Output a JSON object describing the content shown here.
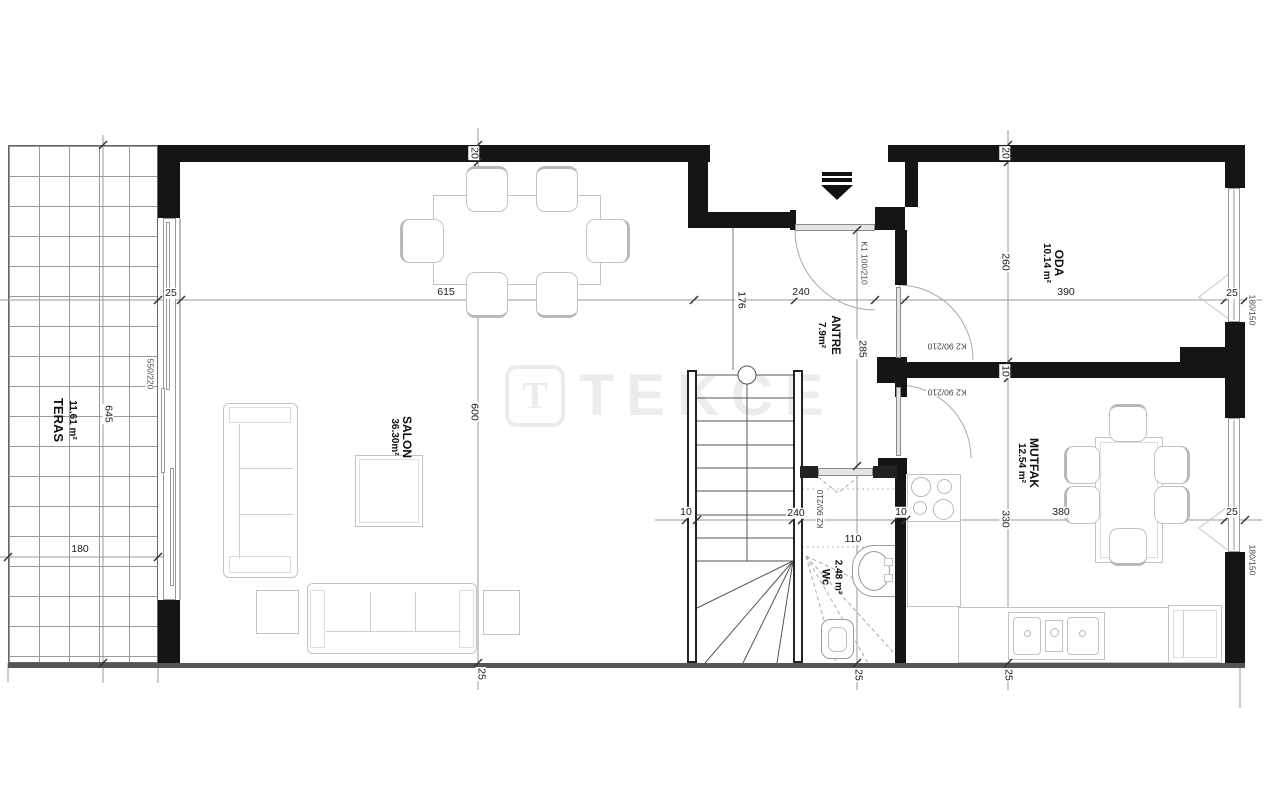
{
  "watermark": {
    "logo_letter": "T",
    "brand": "TEKCE"
  },
  "rooms": {
    "teras": {
      "line1": "11.61 m²",
      "line2": "TERAS"
    },
    "salon": {
      "line1": "SALON",
      "line2": "36.30m²"
    },
    "antre": {
      "line1": "ANTRE",
      "line2": "7.9m²"
    },
    "oda": {
      "line1": "ODA",
      "line2": "10.14 m²"
    },
    "mutfak": {
      "line1": "MUTFAK",
      "line2": "12.54 m²"
    },
    "wc": {
      "line1": "2.48 m²",
      "line2": "Wc"
    }
  },
  "doors": {
    "k1": "K1 100/210",
    "k2_oda": "K2 90/210",
    "k2_mutfak": "K2 90/210",
    "k2_wc": "K2 90/210"
  },
  "windows": {
    "left": "550/220",
    "oda_right": "180/150",
    "mutfak_right": "180/150"
  },
  "dims": {
    "d25_left": "25",
    "d615": "615",
    "d240_top": "240",
    "d390": "390",
    "d25_oda": "25",
    "d180": "180",
    "d645": "645",
    "d10_a": "10",
    "d240_st": "240",
    "d10_b": "10",
    "d110": "110",
    "d380": "380",
    "d25_mut": "25",
    "d20_s": "20",
    "d600": "600",
    "d25_s": "25",
    "d20_o": "20",
    "d260": "260",
    "d10_w": "10",
    "d330": "330",
    "d25_ob": "25",
    "d176": "176",
    "d285": "285",
    "d25_wc": "25"
  },
  "colors": {
    "wall": "#151515",
    "dimline": "#999999",
    "furniture": "#c3c3c3",
    "watermark": "#ececec"
  }
}
